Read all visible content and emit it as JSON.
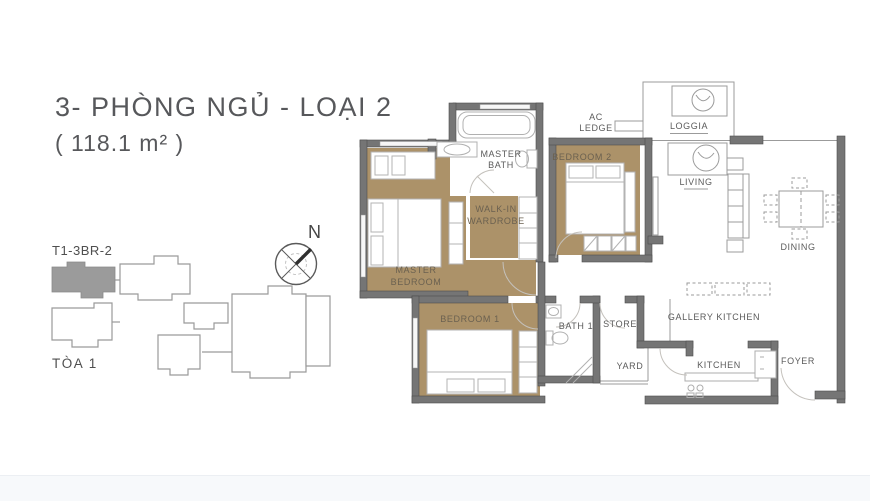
{
  "header": {
    "title": "3- PHÒNG NGỦ - LOẠI 2",
    "area": "( 118.1 m² )"
  },
  "key_plan": {
    "unit_label": "T1-3BR-2",
    "tower_label": "TÒA 1"
  },
  "compass": {
    "north_label": "N"
  },
  "colors": {
    "room_fill_tan": "#ac9269",
    "wall_gray": "#757575",
    "outline_gray": "#9b9b9b",
    "title_text": "#57585b",
    "label_text": "#5b5b5b",
    "keyplan_highlight": "#9b9b9b"
  },
  "floor_plan": {
    "rooms": {
      "master_bath": [
        "MASTER",
        "BATH"
      ],
      "ac_ledge": [
        "AC",
        "LEDGE"
      ],
      "loggia": [
        "LOGGIA"
      ],
      "bedroom_2": [
        "BEDROOM 2"
      ],
      "living": [
        "LIVING"
      ],
      "dining": [
        "DINING"
      ],
      "walk_in_wardrobe": [
        "WALK-IN",
        "WARDROBE"
      ],
      "master_bedroom": [
        "MASTER",
        "BEDROOM"
      ],
      "bedroom_1": [
        "BEDROOM 1"
      ],
      "bath_1": [
        "BATH 1"
      ],
      "store": [
        "STORE"
      ],
      "gallery_kitchen": [
        "GALLERY KITCHEN"
      ],
      "yard": [
        "YARD"
      ],
      "kitchen": [
        "KITCHEN"
      ],
      "foyer": [
        "FOYER"
      ]
    }
  }
}
